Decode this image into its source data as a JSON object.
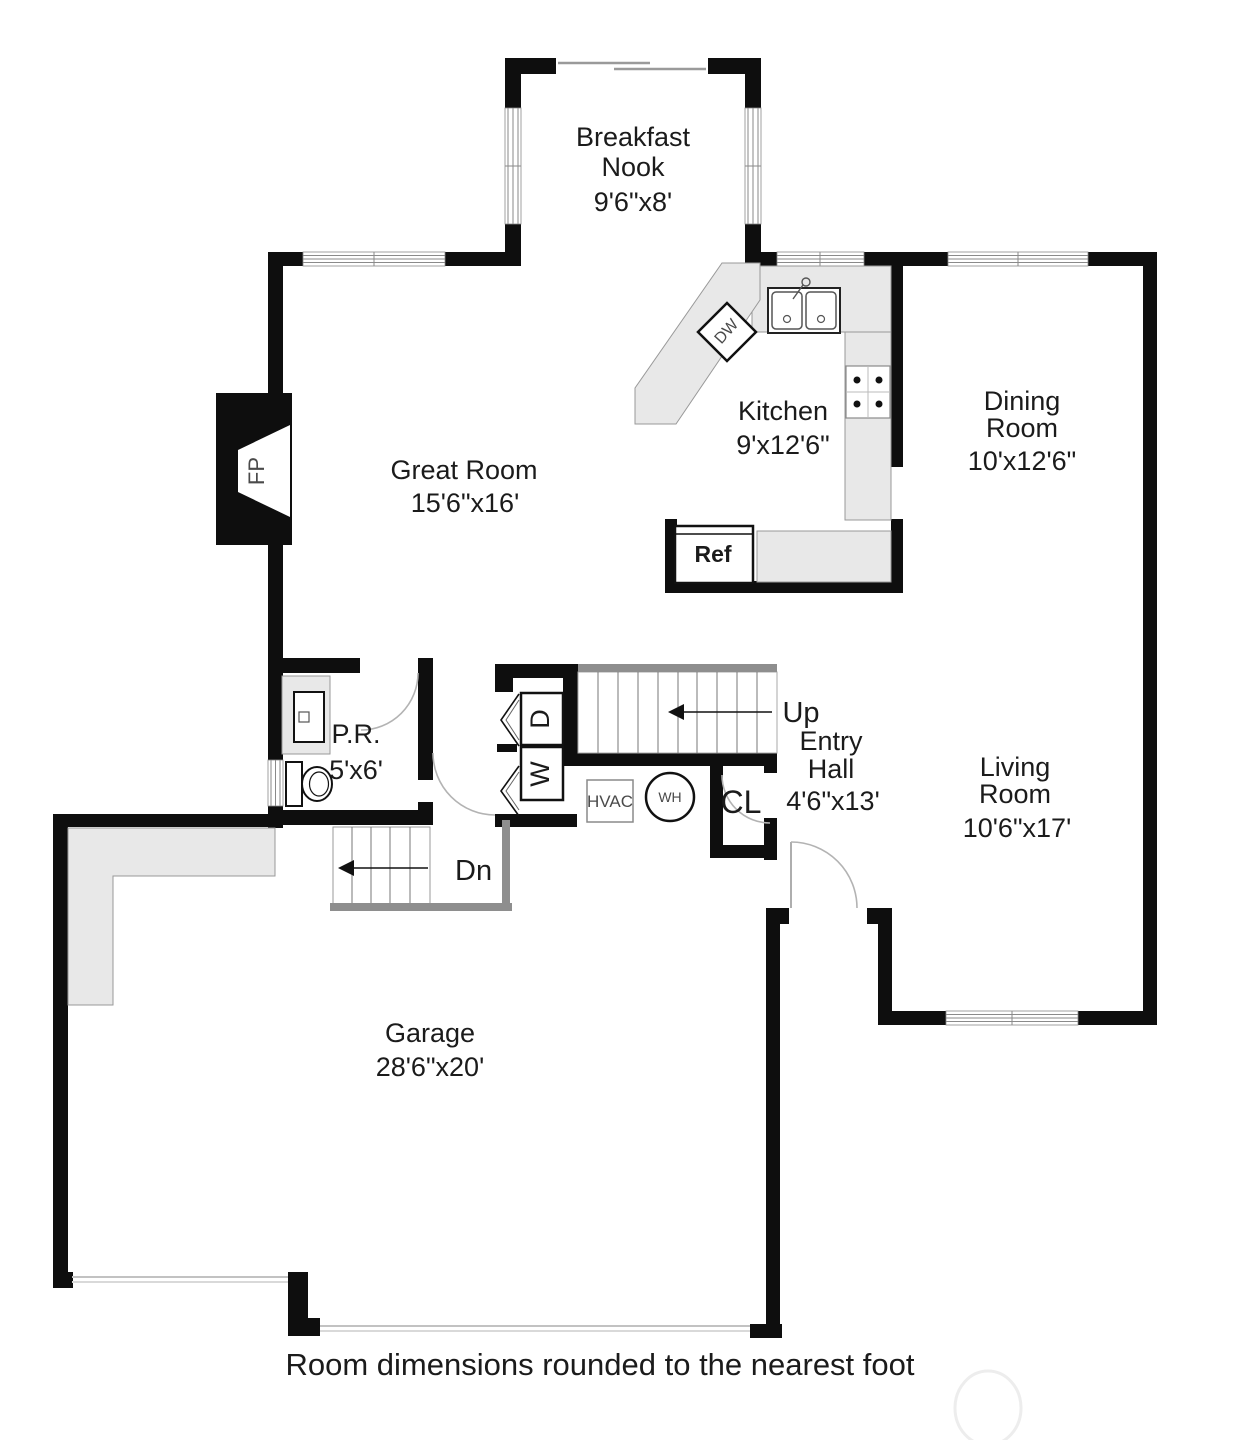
{
  "footer": {
    "note": "Room dimensions rounded to the nearest foot"
  },
  "plan": {
    "rooms": [
      {
        "id": "breakfast-nook",
        "lines": [
          "Breakfast",
          "Nook"
        ],
        "dims": "9'6\"x8'"
      },
      {
        "id": "great-room",
        "lines": [
          "Great Room"
        ],
        "dims": "15'6\"x16'"
      },
      {
        "id": "kitchen",
        "lines": [
          "Kitchen"
        ],
        "dims": "9'x12'6\""
      },
      {
        "id": "dining-room",
        "lines": [
          "Dining",
          "Room"
        ],
        "dims": "10'x12'6\""
      },
      {
        "id": "powder-room",
        "lines": [
          "P.R."
        ],
        "dims": "5'x6'"
      },
      {
        "id": "entry-hall",
        "lines": [
          "Entry",
          "Hall"
        ],
        "dims": "4'6\"x13'"
      },
      {
        "id": "living-room",
        "lines": [
          "Living",
          "Room"
        ],
        "dims": "10'6\"x17'"
      },
      {
        "id": "garage",
        "lines": [
          "Garage"
        ],
        "dims": "28'6\"x20'"
      }
    ],
    "labels": {
      "fireplace": "FP",
      "dishwasher": "DW",
      "refrigerator": "Ref",
      "dryer": "D",
      "washer": "W",
      "hvac": "HVAC",
      "water_heater": "WH",
      "closet": "CL",
      "stairs_up": "Up",
      "stairs_down": "Dn"
    },
    "colors": {
      "wall": "#0e0e0e",
      "counter": "#e8e8e8",
      "counter_border": "#999999",
      "stair_rail": "#8e8e8e",
      "door_arc": "#b3b3b3",
      "text": "#1b1b1b",
      "fixture_text": "#4a4a4a"
    }
  }
}
